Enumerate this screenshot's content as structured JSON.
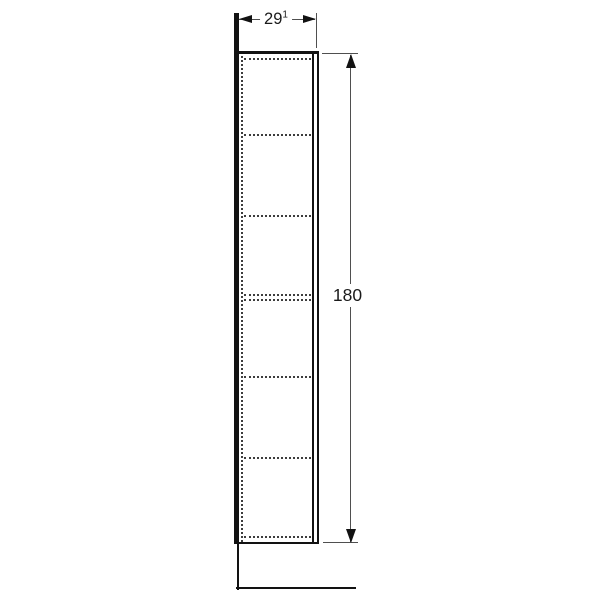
{
  "drawing": {
    "description": "Side elevation technical drawing of a tall narrow cabinet with six compartments shown by dashed hidden lines, standing on a base, with width and height dimension annotations",
    "width_dimension": {
      "value": "29",
      "footnote": "1",
      "display": "29¹"
    },
    "height_dimension": {
      "value": "180"
    },
    "shelf_dashed_line_y": [
      58.5,
      134.5,
      215.5,
      294.5,
      300,
      376.5,
      457.5,
      537
    ],
    "colors": {
      "background": "#ffffff",
      "outline": "#121212",
      "hidden_line": "#3d3d3d",
      "dimension_line": "#4f4f4f",
      "text": "#1a1a1a"
    }
  }
}
